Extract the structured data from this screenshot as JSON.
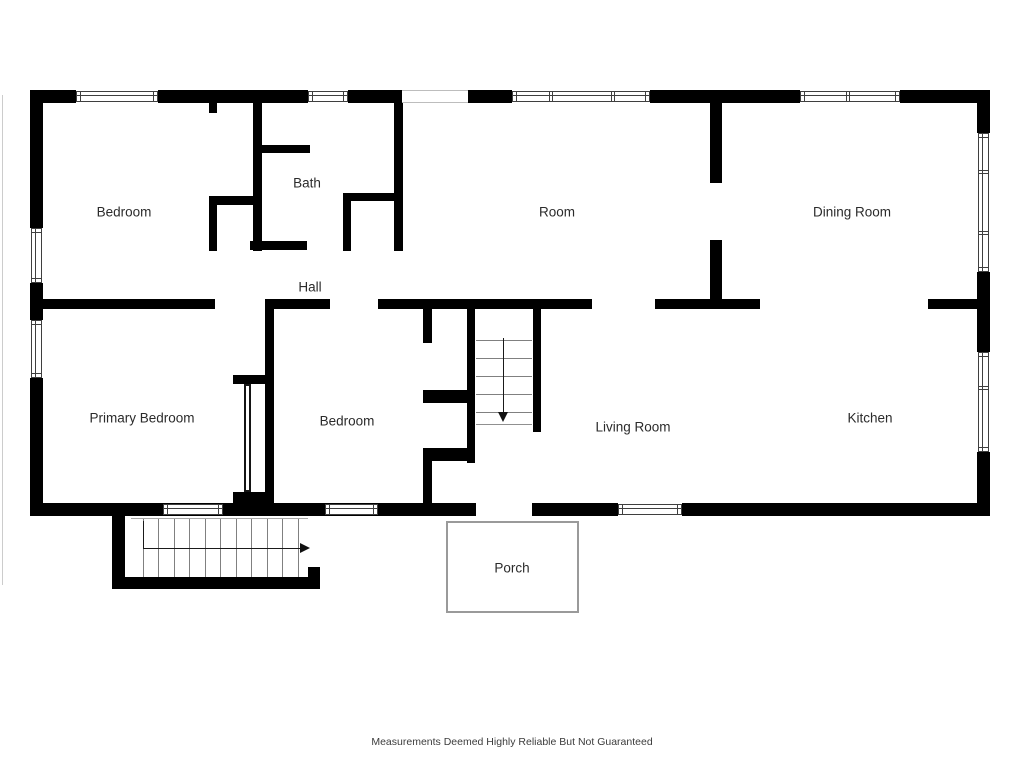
{
  "disclaimer": "Measurements Deemed Highly Reliable But Not Guaranteed",
  "colors": {
    "wall": "#000000",
    "label_text": "#2b2b2b",
    "window_frame": "#3f3f3f",
    "stair_line": "#808080",
    "arrow": "#1a1a1a",
    "porch_border": "#9a9a9a",
    "background": "#ffffff"
  },
  "rooms": [
    {
      "name": "bedroom-upper",
      "label": "Bedroom",
      "x": 124,
      "y": 212
    },
    {
      "name": "bath",
      "label": "Bath",
      "x": 307,
      "y": 183
    },
    {
      "name": "room",
      "label": "Room",
      "x": 557,
      "y": 212
    },
    {
      "name": "dining-room",
      "label": "Dining Room",
      "x": 852,
      "y": 212
    },
    {
      "name": "hall",
      "label": "Hall",
      "x": 310,
      "y": 287
    },
    {
      "name": "primary-bedroom",
      "label": "Primary Bedroom",
      "x": 142,
      "y": 418
    },
    {
      "name": "bedroom-lower",
      "label": "Bedroom",
      "x": 347,
      "y": 421
    },
    {
      "name": "living-room",
      "label": "Living Room",
      "x": 633,
      "y": 427
    },
    {
      "name": "kitchen",
      "label": "Kitchen",
      "x": 870,
      "y": 418
    },
    {
      "name": "porch",
      "label": "Porch",
      "x": 512,
      "y": 568
    }
  ],
  "floorplan": {
    "walls": [
      [
        30,
        90,
        46,
        13
      ],
      [
        158,
        90,
        150,
        13
      ],
      [
        348,
        90,
        54,
        13
      ],
      [
        468,
        90,
        44,
        13
      ],
      [
        650,
        90,
        150,
        13
      ],
      [
        900,
        90,
        90,
        13
      ],
      [
        30,
        90,
        13,
        138
      ],
      [
        30,
        283,
        13,
        37
      ],
      [
        30,
        378,
        13,
        138
      ],
      [
        977,
        90,
        13,
        43
      ],
      [
        977,
        272,
        13,
        80
      ],
      [
        977,
        452,
        13,
        64
      ],
      [
        30,
        503,
        446,
        13
      ],
      [
        532,
        503,
        86,
        13
      ],
      [
        682,
        503,
        308,
        13
      ],
      [
        209,
        103,
        8,
        10
      ],
      [
        209,
        196,
        44,
        9
      ],
      [
        209,
        196,
        8,
        55
      ],
      [
        253,
        103,
        9,
        148
      ],
      [
        262,
        145,
        48,
        8
      ],
      [
        394,
        103,
        9,
        148
      ],
      [
        343,
        193,
        60,
        8
      ],
      [
        343,
        201,
        8,
        50
      ],
      [
        250,
        241,
        57,
        9
      ],
      [
        710,
        103,
        12,
        80
      ],
      [
        710,
        240,
        12,
        59
      ],
      [
        30,
        299,
        185,
        10
      ],
      [
        265,
        299,
        65,
        10
      ],
      [
        378,
        299,
        214,
        10
      ],
      [
        655,
        299,
        105,
        10
      ],
      [
        928,
        299,
        62,
        10
      ],
      [
        265,
        308,
        9,
        208
      ],
      [
        233,
        375,
        32,
        9
      ],
      [
        233,
        492,
        32,
        11
      ],
      [
        423,
        308,
        9,
        35
      ],
      [
        423,
        390,
        52,
        13
      ],
      [
        423,
        448,
        52,
        13
      ],
      [
        423,
        448,
        9,
        68
      ],
      [
        467,
        308,
        8,
        155
      ],
      [
        533,
        308,
        8,
        124
      ],
      [
        112,
        516,
        13,
        73
      ],
      [
        112,
        577,
        208,
        12
      ],
      [
        308,
        567,
        12,
        10
      ]
    ],
    "openings": [
      {
        "x": 402,
        "y": 90,
        "w": 66,
        "h": 13
      }
    ],
    "windows": [
      {
        "x": 76,
        "y": 91,
        "w": 82,
        "h": 11,
        "div": []
      },
      {
        "x": 308,
        "y": 91,
        "w": 40,
        "h": 11,
        "div": []
      },
      {
        "x": 512,
        "y": 91,
        "w": 138,
        "h": 11,
        "div": [
          0.275,
          0.725
        ]
      },
      {
        "x": 800,
        "y": 91,
        "w": 100,
        "h": 11,
        "div": [
          0.47
        ]
      },
      {
        "x": 31,
        "y": 228,
        "w": 11,
        "h": 55,
        "div": []
      },
      {
        "x": 31,
        "y": 320,
        "w": 11,
        "h": 58,
        "div": []
      },
      {
        "x": 978,
        "y": 133,
        "w": 11,
        "h": 139,
        "div": [
          0.27,
          0.71
        ]
      },
      {
        "x": 978,
        "y": 352,
        "w": 11,
        "h": 100,
        "div": [
          0.35
        ]
      },
      {
        "x": 163,
        "y": 504,
        "w": 60,
        "h": 11,
        "div": []
      },
      {
        "x": 325,
        "y": 504,
        "w": 53,
        "h": 11,
        "div": []
      },
      {
        "x": 618,
        "y": 504,
        "w": 64,
        "h": 11,
        "div": []
      }
    ],
    "porch": {
      "x": 446,
      "y": 521,
      "w": 133,
      "h": 92
    },
    "door_panels": [
      {
        "x": 244,
        "y": 384,
        "w": 7,
        "h": 108
      }
    ],
    "lines": [
      {
        "x1": 476,
        "y1": 340,
        "x2": 532,
        "y2": 340,
        "c": "#808080"
      },
      {
        "x1": 476,
        "y1": 358,
        "x2": 532,
        "y2": 358,
        "c": "#808080"
      },
      {
        "x1": 476,
        "y1": 376,
        "x2": 532,
        "y2": 376,
        "c": "#808080"
      },
      {
        "x1": 476,
        "y1": 394,
        "x2": 532,
        "y2": 394,
        "c": "#808080"
      },
      {
        "x1": 476,
        "y1": 412,
        "x2": 532,
        "y2": 412,
        "c": "#808080"
      },
      {
        "x1": 476,
        "y1": 424,
        "x2": 532,
        "y2": 424,
        "c": "#909090"
      },
      {
        "x1": 503,
        "y1": 338,
        "x2": 503,
        "y2": 413,
        "c": "#1a1a1a"
      },
      {
        "x1": 143,
        "y1": 518,
        "x2": 143,
        "y2": 577,
        "c": "#808080"
      },
      {
        "x1": 158,
        "y1": 518,
        "x2": 158,
        "y2": 577,
        "c": "#808080"
      },
      {
        "x1": 174,
        "y1": 518,
        "x2": 174,
        "y2": 577,
        "c": "#808080"
      },
      {
        "x1": 189,
        "y1": 518,
        "x2": 189,
        "y2": 577,
        "c": "#808080"
      },
      {
        "x1": 205,
        "y1": 518,
        "x2": 205,
        "y2": 577,
        "c": "#808080"
      },
      {
        "x1": 220,
        "y1": 518,
        "x2": 220,
        "y2": 577,
        "c": "#808080"
      },
      {
        "x1": 236,
        "y1": 518,
        "x2": 236,
        "y2": 577,
        "c": "#808080"
      },
      {
        "x1": 251,
        "y1": 518,
        "x2": 251,
        "y2": 577,
        "c": "#808080"
      },
      {
        "x1": 267,
        "y1": 518,
        "x2": 267,
        "y2": 577,
        "c": "#808080"
      },
      {
        "x1": 282,
        "y1": 518,
        "x2": 282,
        "y2": 577,
        "c": "#808080"
      },
      {
        "x1": 298,
        "y1": 518,
        "x2": 298,
        "y2": 577,
        "c": "#808080"
      },
      {
        "x1": 131,
        "y1": 518,
        "x2": 308,
        "y2": 518,
        "c": "#a8a8a8"
      },
      {
        "x1": 143,
        "y1": 521,
        "x2": 143,
        "y2": 548,
        "c": "#1a1a1a"
      },
      {
        "x1": 143,
        "y1": 548,
        "x2": 300,
        "y2": 548,
        "c": "#1a1a1a"
      },
      {
        "x1": 2,
        "y1": 95,
        "x2": 2,
        "y2": 585,
        "c": "#cccccc"
      }
    ],
    "arrows": [
      {
        "dir": "down",
        "x": 503,
        "y": 412
      },
      {
        "dir": "right",
        "x": 300,
        "y": 548
      }
    ]
  },
  "disclaimer_pos": {
    "x": 512,
    "y": 736
  }
}
